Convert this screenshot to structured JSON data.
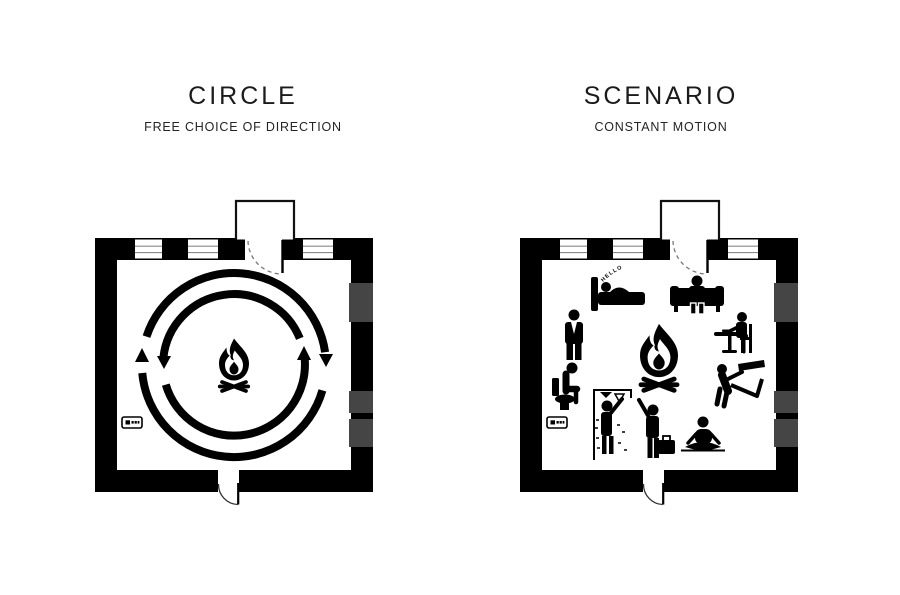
{
  "page": {
    "background_color": "#ffffff",
    "ink_color": "#000000",
    "window_gray": "#454545",
    "frame_line_gray": "#8a8a8a"
  },
  "panels": {
    "circle": {
      "title": "CIRCLE",
      "subtitle": "FREE CHOICE OF DIRECTION",
      "plan": {
        "center_icon": "campfire",
        "motion_rings": {
          "outer_direction": "clockwise",
          "inner_direction": "counterclockwise"
        }
      }
    },
    "scenario": {
      "title": "SCENARIO",
      "subtitle": "CONSTANT MOTION",
      "speech_text": "HELLO",
      "plan": {
        "center_icon": "campfire",
        "activity_icons": [
          "sleeping-in-bed",
          "sitting-on-sofa",
          "standing-person",
          "eating-at-table",
          "sitting-on-toilet",
          "making-bed",
          "showering",
          "arriving-with-suitcase",
          "meditating"
        ]
      }
    }
  }
}
